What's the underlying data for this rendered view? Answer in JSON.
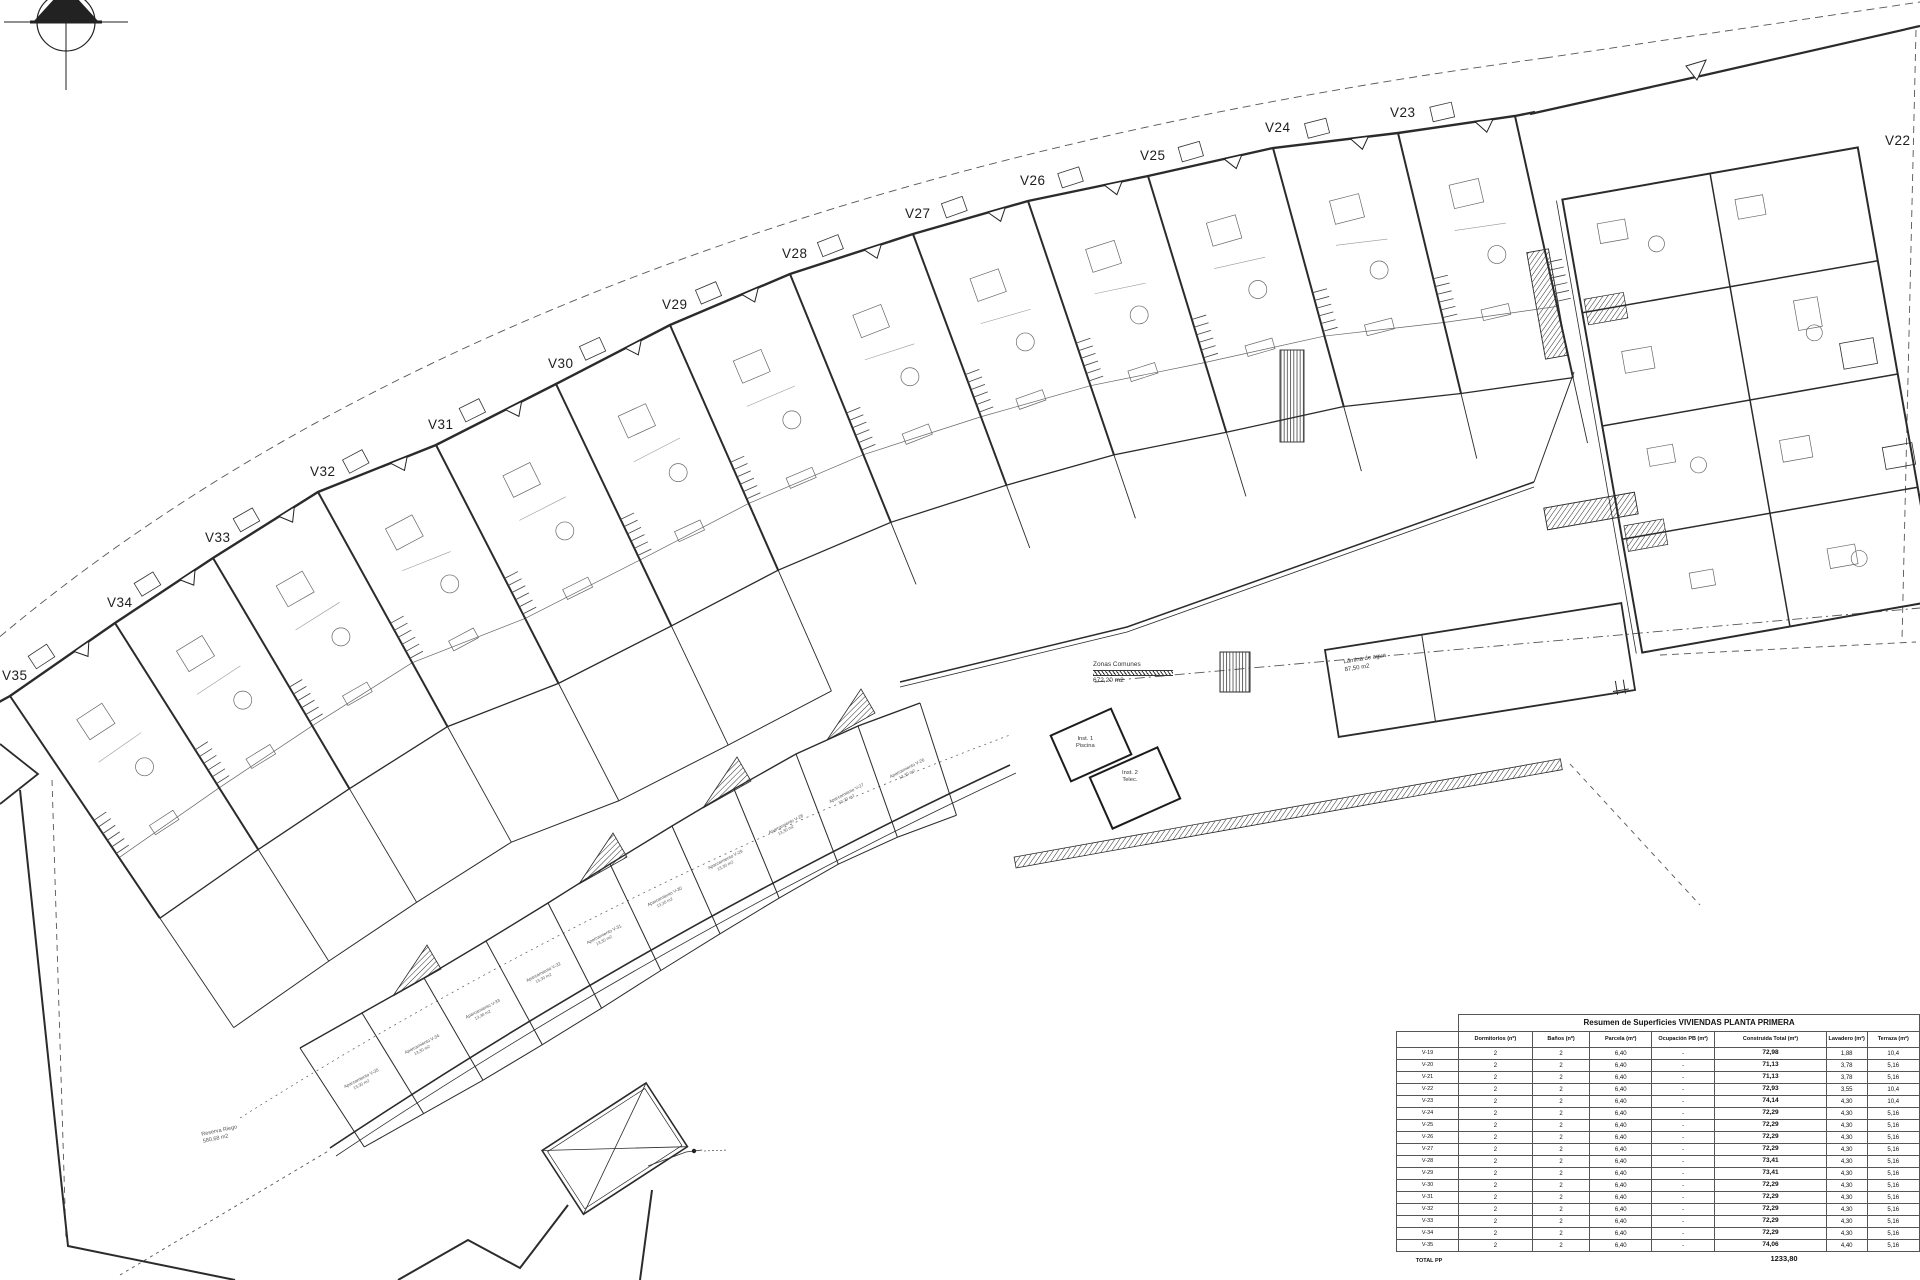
{
  "sheet": {
    "background": "#ffffff",
    "line_color": "#2b2b2b"
  },
  "plan": {
    "units": [
      {
        "id": "V35",
        "label": "V35",
        "x": 2,
        "y": 668,
        "angle": -34
      },
      {
        "id": "V34",
        "label": "V34",
        "x": 107,
        "y": 595,
        "angle": -32.3
      },
      {
        "id": "V33",
        "label": "V33",
        "x": 205,
        "y": 530,
        "angle": -30.6
      },
      {
        "id": "V32",
        "label": "V32",
        "x": 310,
        "y": 464,
        "angle": -28.9
      },
      {
        "id": "V31",
        "label": "V31",
        "x": 428,
        "y": 417,
        "angle": -27.2
      },
      {
        "id": "V30",
        "label": "V30",
        "x": 548,
        "y": 356,
        "angle": -25.5
      },
      {
        "id": "V29",
        "label": "V29",
        "x": 662,
        "y": 297,
        "angle": -23.8
      },
      {
        "id": "V28",
        "label": "V28",
        "x": 782,
        "y": 246,
        "angle": -22.1
      },
      {
        "id": "V27",
        "label": "V27",
        "x": 905,
        "y": 206,
        "angle": -20.4
      },
      {
        "id": "V26",
        "label": "V26",
        "x": 1020,
        "y": 173,
        "angle": -18.7
      },
      {
        "id": "V25",
        "label": "V25",
        "x": 1140,
        "y": 148,
        "angle": -17
      },
      {
        "id": "V24",
        "label": "V24",
        "x": 1265,
        "y": 120,
        "angle": -15.3
      },
      {
        "id": "V23",
        "label": "V23",
        "x": 1390,
        "y": 105,
        "angle": -13.6
      },
      {
        "id": "V22",
        "label": "V22",
        "x": 1885,
        "y": 133,
        "noDiv": true
      }
    ],
    "wall_end": {
      "x": 1515,
      "y": 116,
      "angle": -12.5
    },
    "parking": {
      "dividers": [
        [
          300,
          1048,
          -33
        ],
        [
          362,
          1013,
          -31.5
        ],
        [
          424,
          978,
          -30
        ],
        [
          486,
          941,
          -28.5
        ],
        [
          548,
          903,
          -27
        ],
        [
          610,
          864,
          -25.5
        ],
        [
          672,
          826,
          -24
        ],
        [
          734,
          789,
          -22.5
        ],
        [
          796,
          754,
          -21
        ],
        [
          858,
          726,
          -19.5
        ],
        [
          920,
          703,
          -18
        ]
      ],
      "labels": [
        {
          "name": "Aparcamiento V-35",
          "area": "13,30 m2"
        },
        {
          "name": "Aparcamiento V-34",
          "area": "13,30 m2"
        },
        {
          "name": "Aparcamiento V-33",
          "area": "13,30 m2"
        },
        {
          "name": "Aparcamiento V-32",
          "area": "13,30 m2"
        },
        {
          "name": "Aparcamiento V-31",
          "area": "13,30 m2"
        },
        {
          "name": "Aparcamiento V-30",
          "area": "13,30 m2"
        },
        {
          "name": "Aparcamiento V-29",
          "area": "13,30 m2"
        },
        {
          "name": "Aparcamiento V-28",
          "area": "13,30 m2"
        },
        {
          "name": "Aparcamiento V-27",
          "area": "13,30 m2"
        },
        {
          "name": "Aparcamiento V-26",
          "area": "13,30 m2"
        }
      ]
    },
    "annotations": {
      "zonas_comunes": {
        "line1": "Zonas Comunes",
        "line2": "672,20 m2"
      },
      "lamina": {
        "line1": "Lámina de agua",
        "line2": "87,50 m2"
      },
      "inst1": {
        "line1": "Inst. 1",
        "line2": "Piscina"
      },
      "inst2": {
        "line1": "Inst. 2",
        "line2": "Telec."
      },
      "reserva": {
        "line1": "Reserva Riego",
        "line2": "580,68 m2"
      }
    }
  },
  "table": {
    "title": "Resumen de Superficies VIVIENDAS PLANTA PRIMERA",
    "columns": [
      "",
      "Dormitorios (nº)",
      "Baños (nº)",
      "Parcela (m²)",
      "Ocupación PB (m²)",
      "Construida Total (m²)",
      "Lavadero (m²)",
      "Terraza (m²)"
    ],
    "rows": [
      [
        "V-19",
        "2",
        "2",
        "6,40",
        "-",
        "72,98",
        "1,88",
        "10,4"
      ],
      [
        "V-20",
        "2",
        "2",
        "6,40",
        "-",
        "71,13",
        "3,78",
        "5,16"
      ],
      [
        "V-21",
        "2",
        "2",
        "6,40",
        "-",
        "71,13",
        "3,78",
        "5,16"
      ],
      [
        "V-22",
        "2",
        "2",
        "6,40",
        "-",
        "72,93",
        "3,55",
        "10,4"
      ],
      [
        "V-23",
        "2",
        "2",
        "6,40",
        "-",
        "74,14",
        "4,30",
        "10,4"
      ],
      [
        "V-24",
        "2",
        "2",
        "6,40",
        "-",
        "72,29",
        "4,30",
        "5,16"
      ],
      [
        "V-25",
        "2",
        "2",
        "6,40",
        "-",
        "72,29",
        "4,30",
        "5,16"
      ],
      [
        "V-26",
        "2",
        "2",
        "6,40",
        "-",
        "72,29",
        "4,30",
        "5,16"
      ],
      [
        "V-27",
        "2",
        "2",
        "6,40",
        "-",
        "72,29",
        "4,30",
        "5,16"
      ],
      [
        "V-28",
        "2",
        "2",
        "6,40",
        "-",
        "73,41",
        "4,30",
        "5,16"
      ],
      [
        "V-29",
        "2",
        "2",
        "6,40",
        "-",
        "73,41",
        "4,30",
        "5,16"
      ],
      [
        "V-30",
        "2",
        "2",
        "6,40",
        "-",
        "72,29",
        "4,30",
        "5,16"
      ],
      [
        "V-31",
        "2",
        "2",
        "6,40",
        "-",
        "72,29",
        "4,30",
        "5,16"
      ],
      [
        "V-32",
        "2",
        "2",
        "6,40",
        "-",
        "72,29",
        "4,30",
        "5,16"
      ],
      [
        "V-33",
        "2",
        "2",
        "6,40",
        "-",
        "72,29",
        "4,30",
        "5,16"
      ],
      [
        "V-34",
        "2",
        "2",
        "6,40",
        "-",
        "72,29",
        "4,30",
        "5,16"
      ],
      [
        "V-35",
        "2",
        "2",
        "6,40",
        "-",
        "74,06",
        "4,40",
        "5,16"
      ]
    ],
    "total_label": "TOTAL PP",
    "total_construida": "1233,80"
  }
}
